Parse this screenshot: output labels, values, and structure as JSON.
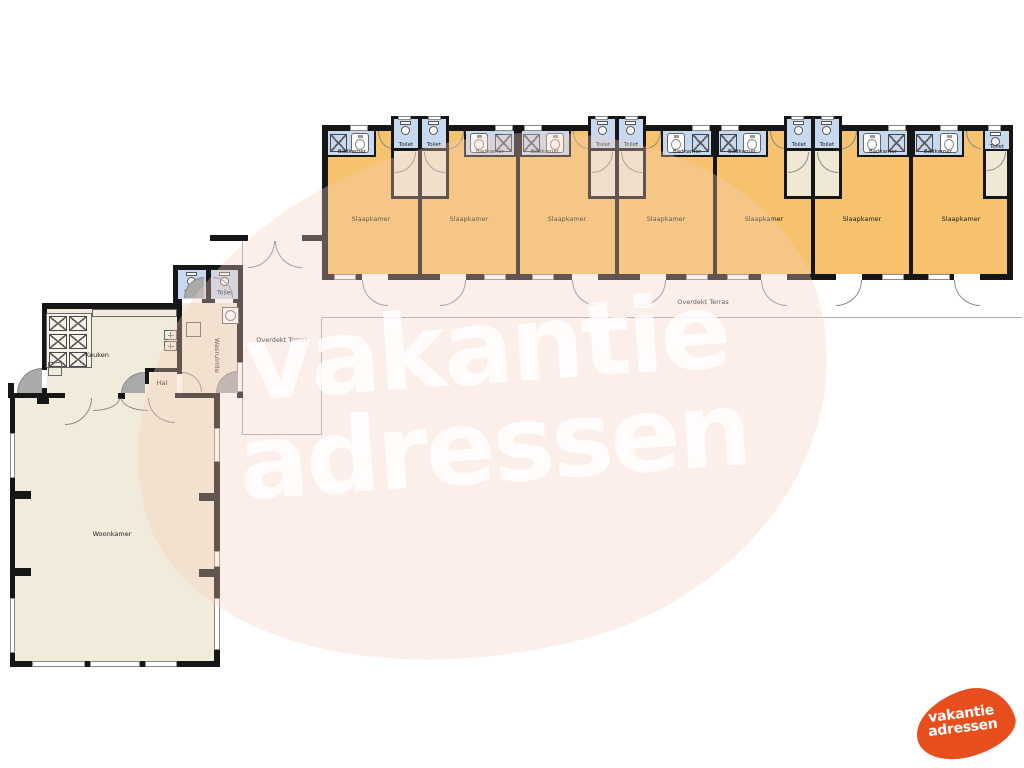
{
  "watermark": {
    "line1": "vakantie",
    "line2": "adressen"
  },
  "logo": {
    "line1": "vakantie",
    "line2": "adressen"
  },
  "rooms": {
    "bedroom": "Slaapkamer",
    "bathroom": "Badkamer",
    "toilet": "Toilet",
    "kitchen": "Keuken",
    "hall": "Hal",
    "laundry": "Wasruimte",
    "living_room": "Woonkamer",
    "covered_terrace": "Overdekt Terras"
  },
  "summary": {
    "bedrooms": 7,
    "bathrooms": 7,
    "toilets": 9,
    "terrace_labels": 2
  },
  "colors": {
    "bedroom_fill": "#f6c26d",
    "wet_room_fill": "#c6d9f0",
    "living_fill": "#f1ebdb",
    "wall": "#161616",
    "logo_orange": "#e84e1d",
    "watermark_tint": "rgba(246,204,188,0.34)"
  }
}
